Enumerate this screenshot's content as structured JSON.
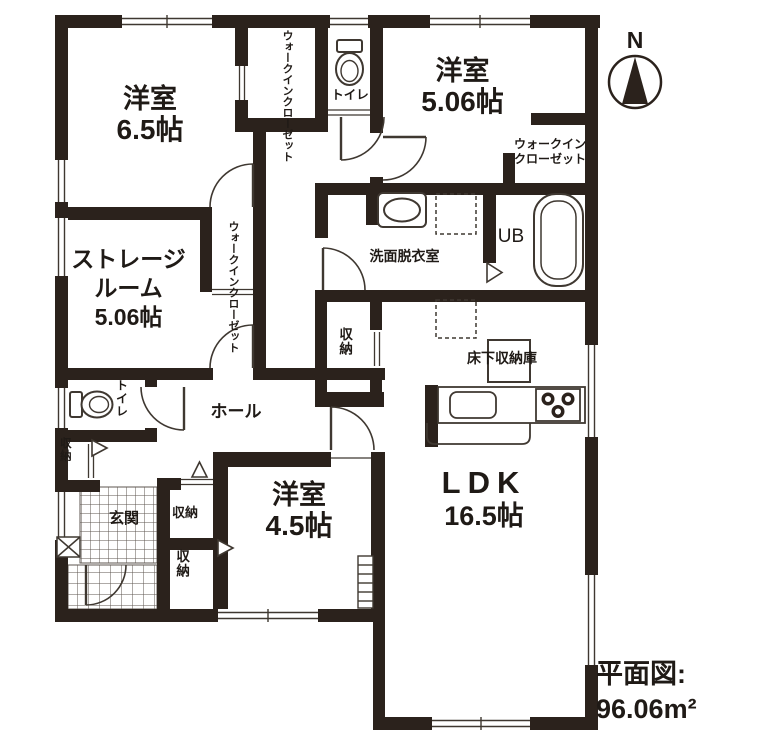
{
  "compass": {
    "label": "N"
  },
  "caption": {
    "title": "平面図:",
    "area": "96.06m²"
  },
  "rooms": {
    "bedroom1": {
      "name": "洋室",
      "area": "6.5帖"
    },
    "bedroom2": {
      "name": "洋室",
      "area": "5.06帖"
    },
    "bedroom3": {
      "name": "洋室",
      "area": "4.5帖"
    },
    "storage": {
      "name1": "ストレージ",
      "name2": "ルーム",
      "area": "5.06帖"
    },
    "ldk": {
      "name": "LDK",
      "area": "16.5帖"
    },
    "hall": {
      "name": "ホール"
    },
    "entrance": {
      "name": "玄関"
    },
    "washroom": {
      "name": "洗面脱衣室"
    },
    "unit_bath": {
      "name": "UB"
    },
    "toilet_top": {
      "name": "トイレ"
    },
    "toilet_left": {
      "name": "トイレ"
    },
    "wic_top": {
      "name": "ウォークインクローゼット"
    },
    "wic_mid": {
      "name": "ウォークインクローゼット"
    },
    "wic_right": {
      "line1": "ウォークイン",
      "line2": "クローゼット"
    },
    "underfloor_storage": {
      "name": "床下収納庫"
    },
    "closet_mid": {
      "name": "収納"
    },
    "closet_left": {
      "name": "収納"
    },
    "closet_entry_upper": {
      "name": "収納"
    },
    "closet_entry_lower": {
      "name": "収納"
    }
  },
  "colors": {
    "wall": "#2b221c",
    "line": "#3f3831",
    "text": "#1f1a16",
    "background": "#ffffff"
  }
}
